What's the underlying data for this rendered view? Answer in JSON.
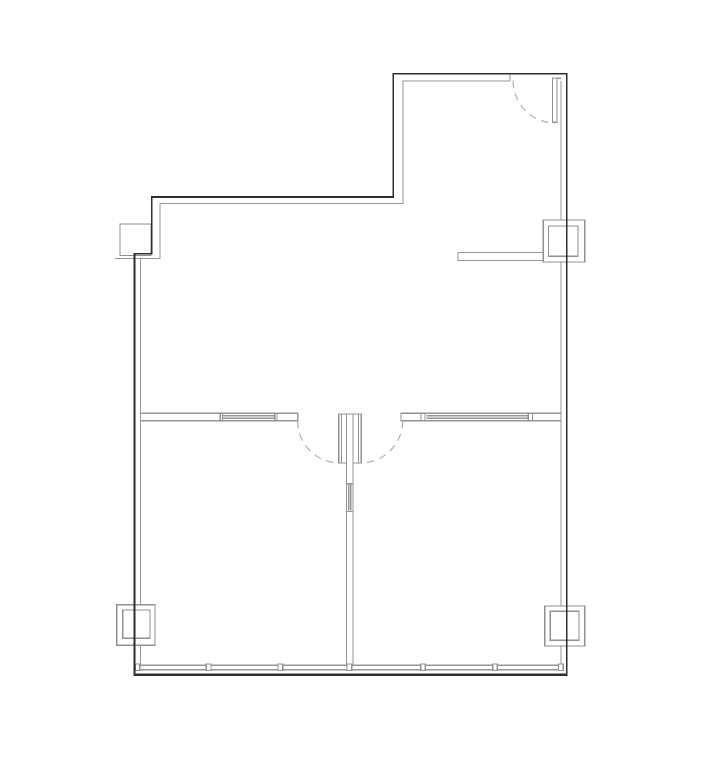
{
  "canvas": {
    "width": 727,
    "height": 765
  },
  "colors": {
    "background": "#ffffff",
    "wall_dark": "#2d2d2d",
    "wall_light": "#969696",
    "fixture_stroke": "#909090",
    "fixture_fill": "#ffffff",
    "door_arc": "#b0b0b0"
  },
  "plan": {
    "wall_segments_gray": [
      {
        "name": "upper-suite-inner-face",
        "d": "M510,81 H403 V203.5 H160 V258.5 H115"
      },
      {
        "name": "left-wall-inner-upper",
        "d": "M140.5,258.5 V604.6"
      },
      {
        "name": "left-wall-inner-lower",
        "d": "M140.5,645.5 V665.2"
      },
      {
        "name": "right-wall-inner-top",
        "d": "M561,81 V219.8"
      },
      {
        "name": "right-wall-inner-mid",
        "d": "M561,262.2 V605.8"
      },
      {
        "name": "right-wall-inner-bottom",
        "d": "M561,646.2 V665.2"
      },
      {
        "name": "stub-wall-upper-right",
        "d": "M548.8,252.4 H458 V260.4 H543.5"
      },
      {
        "name": "partition-wall-left",
        "d": "M140.5,413.2 H297.6 V420.6 H140.5"
      },
      {
        "name": "partition-wall-left-glazing",
        "d": "M222.5,415.6 H274.8 M222.5,418.2 H274.8"
      },
      {
        "name": "partition-wall-right",
        "d": "M401,420.6 V413.2 H561 M401,420.6 H561"
      },
      {
        "name": "partition-wall-right-glazing",
        "d": "M426.5,415.6 H528 M426.5,418.2 H528"
      },
      {
        "name": "center-partition-wall",
        "d": "M346.5,414 V665.2 M353,414 V665.2"
      },
      {
        "name": "center-partition-top-cap",
        "d": "M338.8,414 H361.3"
      },
      {
        "name": "center-door-jamb-caps",
        "d": "M341.6,463 H346.5 M353,463 H358.5"
      },
      {
        "name": "center-partition-marker",
        "d": "M346.5,483.6 H353 M346.5,511.4 H353 M348.7,484.5 V510.5 M350.8,484.5 V510.5"
      },
      {
        "name": "window-wall-glass-lines",
        "d": "M140.5,665.2 H561 M140.5,669.6 H561"
      },
      {
        "name": "door-top-right-head-connector",
        "d": "M557,78.2 H561"
      },
      {
        "name": "door-opening-cap-top-wall",
        "d": "M510,74.5 V81"
      }
    ],
    "fixtures_white": [
      {
        "name": "column-top-left",
        "x": 120,
        "y": 224,
        "w": 31,
        "h": 31.5
      },
      {
        "name": "column-right-outer",
        "x": 543.3,
        "y": 220,
        "w": 41.4,
        "h": 42
      },
      {
        "name": "column-right-inner",
        "x": 548.6,
        "y": 226,
        "w": 29.4,
        "h": 30.3
      },
      {
        "name": "column-bottom-left-outer",
        "x": 116.8,
        "y": 604.8,
        "w": 38.2,
        "h": 40.5
      },
      {
        "name": "column-bottom-left-inner",
        "x": 122.7,
        "y": 610,
        "w": 27.3,
        "h": 28.3
      },
      {
        "name": "column-bottom-right-outer",
        "x": 544.7,
        "y": 606,
        "w": 40,
        "h": 40
      },
      {
        "name": "column-bottom-right-inner",
        "x": 550.3,
        "y": 611.3,
        "w": 28.7,
        "h": 29
      },
      {
        "name": "door-leaf-top-right",
        "x": 552.5,
        "y": 78,
        "w": 4.5,
        "h": 44.3
      },
      {
        "name": "door-leaf-center-left",
        "x": 338.8,
        "y": 414,
        "w": 2.8,
        "h": 49
      },
      {
        "name": "door-leaf-center-right",
        "x": 358.5,
        "y": 414,
        "w": 2.8,
        "h": 49
      },
      {
        "name": "partition-right-jamb-box",
        "x": 401,
        "y": 413.2,
        "w": 20,
        "h": 7.4
      },
      {
        "name": "partition-right-jamb-tick",
        "x": 421,
        "y": 413.2,
        "w": 4,
        "h": 7.4
      },
      {
        "name": "partition-right-glazing-tick",
        "x": 528.2,
        "y": 413.2,
        "w": 4.2,
        "h": 7.4
      },
      {
        "name": "partition-left-glazing-tick-a",
        "x": 220.4,
        "y": 413.2,
        "w": 2.2,
        "h": 7.4
      },
      {
        "name": "partition-left-glazing-tick-b",
        "x": 274.8,
        "y": 413.2,
        "w": 2.2,
        "h": 7.4
      },
      {
        "name": "window-mullion-1",
        "x": 135.2,
        "y": 664.1,
        "w": 4.6,
        "h": 6.5
      },
      {
        "name": "window-mullion-2",
        "x": 206.4,
        "y": 664.1,
        "w": 4.6,
        "h": 6.5
      },
      {
        "name": "window-mullion-3",
        "x": 278.0,
        "y": 664.1,
        "w": 4.6,
        "h": 6.5
      },
      {
        "name": "window-mullion-4",
        "x": 347.0,
        "y": 664.1,
        "w": 4.6,
        "h": 6.5
      },
      {
        "name": "window-mullion-5",
        "x": 420.6,
        "y": 664.1,
        "w": 4.6,
        "h": 6.5
      },
      {
        "name": "window-mullion-6",
        "x": 492.6,
        "y": 664.1,
        "w": 4.6,
        "h": 6.5
      },
      {
        "name": "window-mullion-7",
        "x": 558.6,
        "y": 664.1,
        "w": 4.6,
        "h": 6.5
      }
    ],
    "wall_segments_dark": [
      {
        "name": "exterior-wall-outline",
        "d": "M134.5,675.6 V253.7 H151.8 V197 H393.3 V73.8 H566.8 V675.6",
        "width": 1.8
      },
      {
        "name": "window-wall-outer-edge",
        "d": "M133.6,674.9 H567.7",
        "width": 2.6
      }
    ],
    "door_swings": [
      {
        "name": "door-swing-top-right",
        "d": "M513,80.5 A42.5,42.5 0 0 0 555.5,123"
      },
      {
        "name": "door-swing-center-left",
        "d": "M297.6,421 A42,42 0 0 0 339.6,463"
      },
      {
        "name": "door-swing-center-right",
        "d": "M402.6,421 A42,42 0 0 1 360.6,463"
      }
    ]
  }
}
